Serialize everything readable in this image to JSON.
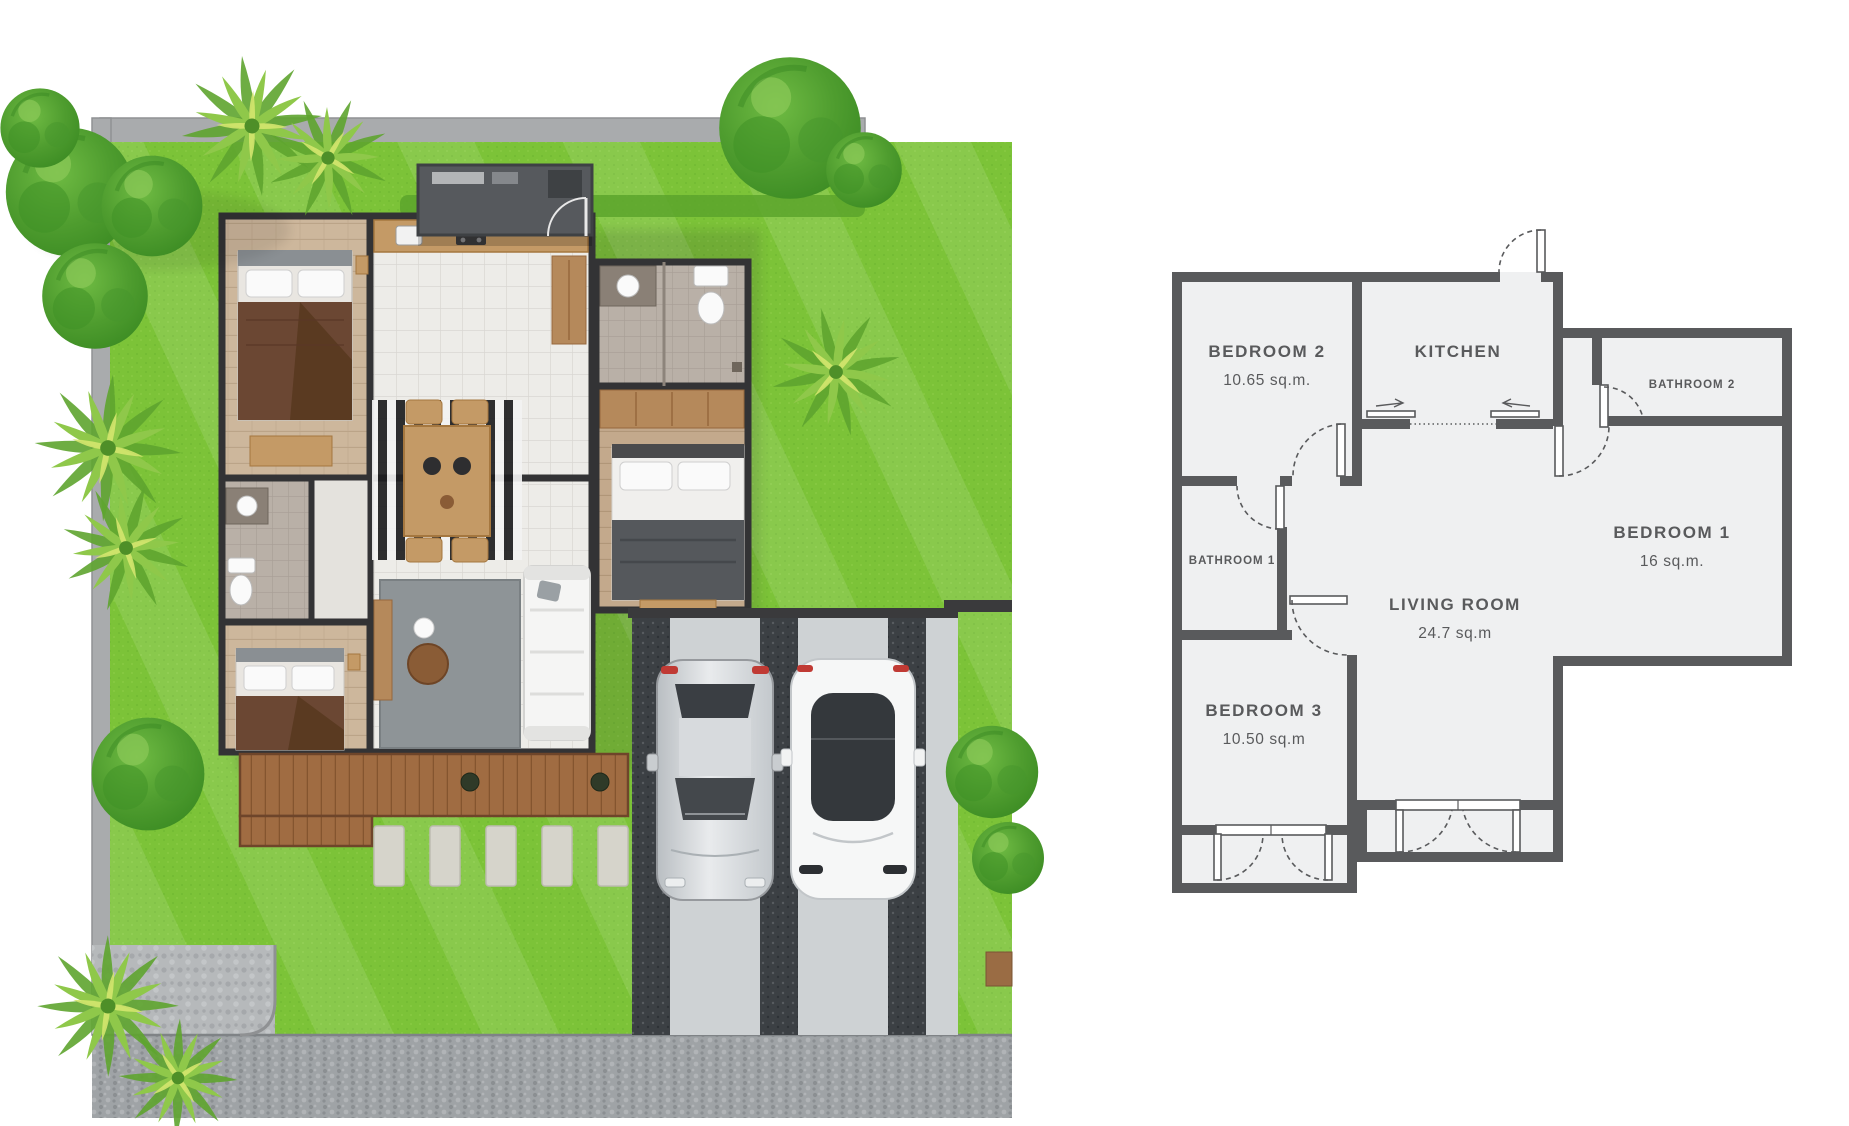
{
  "schematic": {
    "rooms": [
      {
        "key": "bedroom2",
        "label": "BEDROOM 2",
        "area": "10.65 sq.m."
      },
      {
        "key": "kitchen",
        "label": "KITCHEN",
        "area": ""
      },
      {
        "key": "bathroom2",
        "label": "BATHROOM 2",
        "area": ""
      },
      {
        "key": "bedroom1",
        "label": "BEDROOM 1",
        "area": "16 sq.m."
      },
      {
        "key": "bathroom1",
        "label": "BATHROOM 1",
        "area": ""
      },
      {
        "key": "living_room",
        "label": "LIVING ROOM",
        "area": "24.7 sq.m"
      },
      {
        "key": "bedroom3",
        "label": "BEDROOM 3",
        "area": "10.50 sq.m"
      }
    ],
    "colors": {
      "wall": "#595a5c",
      "floor": "#eff0f1",
      "text": "#595a5c"
    }
  },
  "site_plan": {
    "illustration_elements": [
      "lawn",
      "boundary-path",
      "boundary-road",
      "house",
      "wood-deck",
      "stepping-stones",
      "driveway",
      "carport",
      "silver-car",
      "white-car",
      "palm-tree",
      "shade-tree",
      "bed",
      "sofa",
      "dining-table",
      "bathroom-fixtures",
      "entrance-canopy"
    ],
    "colors": {
      "lawn": "#7cc338",
      "path": "#a9abad",
      "road": "#9fa3a6",
      "deck": "#a06c42",
      "driveway": "#ced2d4",
      "driveway_stripe": "#3c4044",
      "wall": "#333335"
    }
  }
}
